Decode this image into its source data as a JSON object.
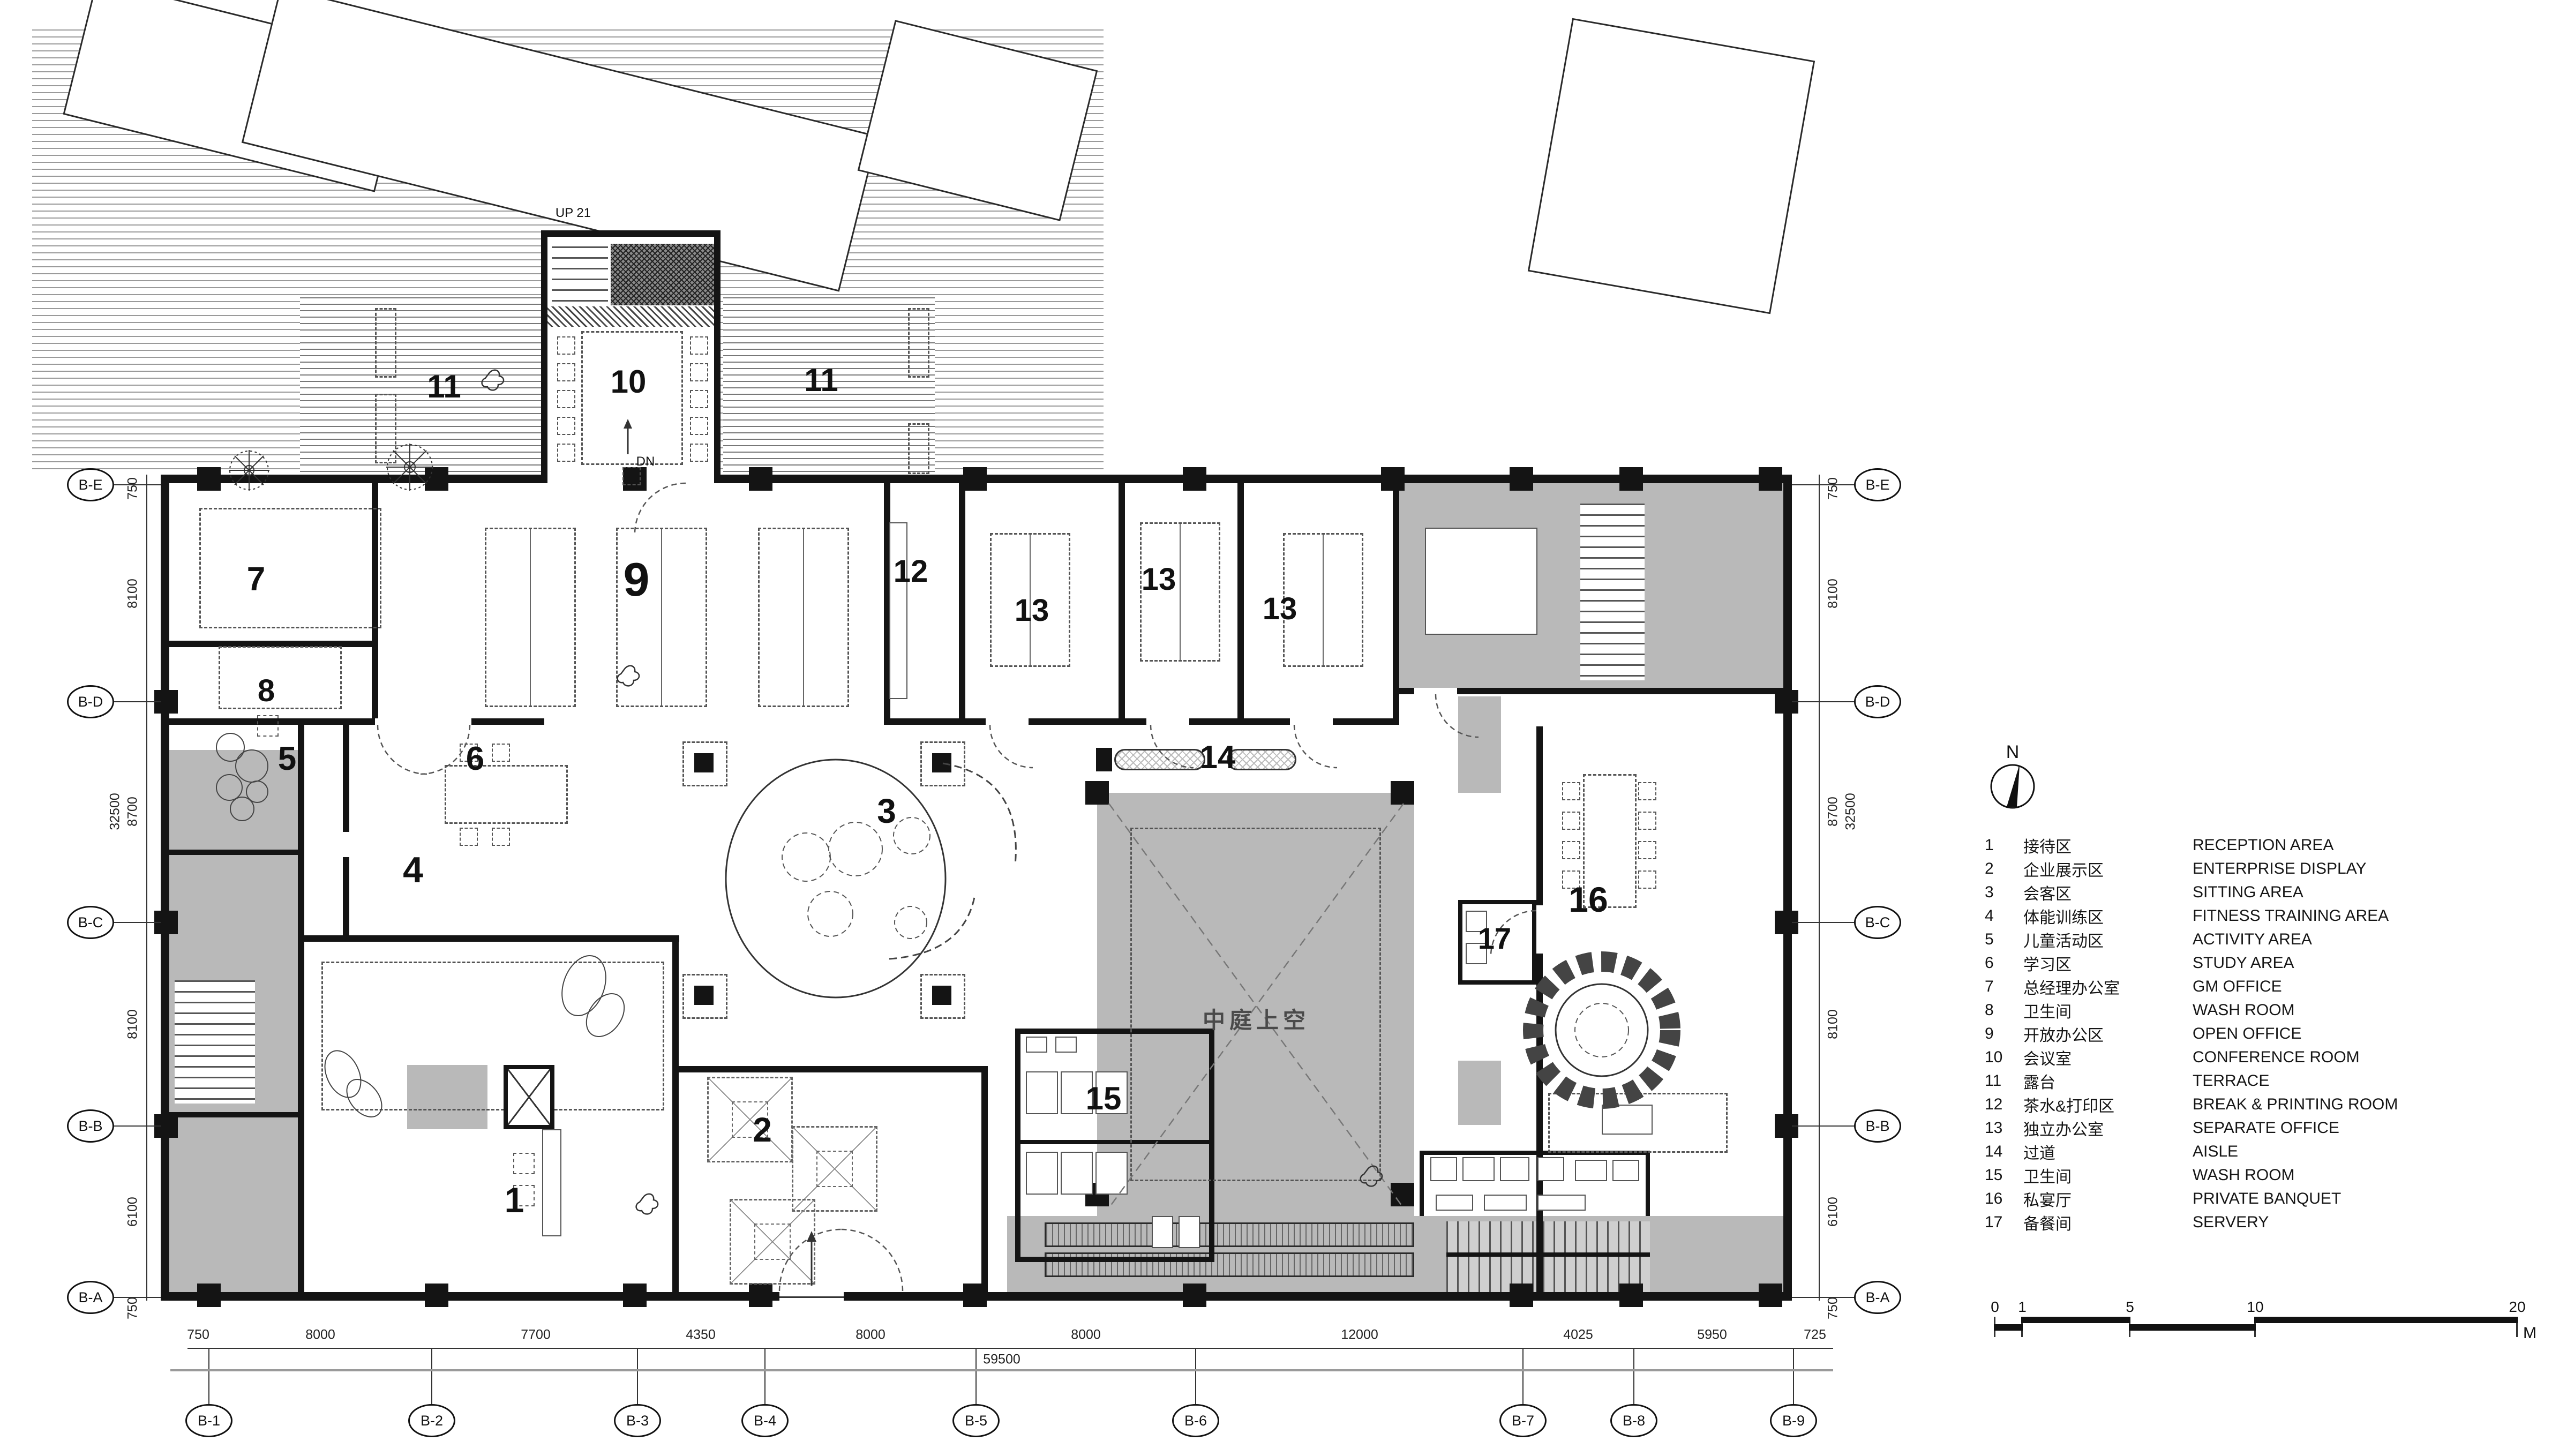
{
  "plan": {
    "rooms": {
      "r1": "1",
      "r2": "2",
      "r3": "3",
      "r4": "4",
      "r5": "5",
      "r6": "6",
      "r7": "7",
      "r8": "8",
      "r9": "9",
      "r10": "10",
      "r11": "11",
      "r12": "12",
      "r13": "13",
      "r14": "14",
      "r15": "15",
      "r16": "16",
      "r17": "17"
    },
    "annotations": {
      "atrium": "中庭上空",
      "up": "UP 21",
      "dn": "DN"
    }
  },
  "legend": {
    "items": [
      {
        "no": "1",
        "zh": "接待区",
        "en": "RECEPTION AREA"
      },
      {
        "no": "2",
        "zh": "企业展示区",
        "en": "ENTERPRISE DISPLAY"
      },
      {
        "no": "3",
        "zh": "会客区",
        "en": "SITTING AREA"
      },
      {
        "no": "4",
        "zh": "体能训练区",
        "en": "FITNESS TRAINING AREA"
      },
      {
        "no": "5",
        "zh": "儿童活动区",
        "en": "ACTIVITY AREA"
      },
      {
        "no": "6",
        "zh": "学习区",
        "en": "STUDY AREA"
      },
      {
        "no": "7",
        "zh": "总经理办公室",
        "en": "GM OFFICE"
      },
      {
        "no": "8",
        "zh": "卫生间",
        "en": "WASH ROOM"
      },
      {
        "no": "9",
        "zh": "开放办公区",
        "en": "OPEN OFFICE"
      },
      {
        "no": "10",
        "zh": "会议室",
        "en": "CONFERENCE ROOM"
      },
      {
        "no": "11",
        "zh": "露台",
        "en": "TERRACE"
      },
      {
        "no": "12",
        "zh": "茶水&打印区",
        "en": "BREAK & PRINTING ROOM"
      },
      {
        "no": "13",
        "zh": "独立办公室",
        "en": "SEPARATE OFFICE"
      },
      {
        "no": "14",
        "zh": "过道",
        "en": "AISLE"
      },
      {
        "no": "15",
        "zh": "卫生间",
        "en": "WASH ROOM"
      },
      {
        "no": "16",
        "zh": "私宴厅",
        "en": "PRIVATE BANQUET"
      },
      {
        "no": "17",
        "zh": "备餐间",
        "en": "SERVERY"
      }
    ]
  },
  "grid": {
    "bottom": [
      "B-1",
      "B-2",
      "B-3",
      "B-4",
      "B-5",
      "B-6",
      "B-7",
      "B-8",
      "B-9"
    ],
    "side": [
      "B-E",
      "B-D",
      "B-C",
      "B-B",
      "B-A"
    ]
  },
  "dimensions": {
    "bottom": [
      "750",
      "8000",
      "7700",
      "4350",
      "8000",
      "8000",
      "12000",
      "4025",
      "5950",
      "725"
    ],
    "bottom_total": "59500",
    "side": [
      "750",
      "8100",
      "8700",
      "8100",
      "6100",
      "750"
    ],
    "side_total": "32500"
  },
  "scalebar": {
    "ticks": [
      "0",
      "1",
      "5",
      "10",
      "20"
    ],
    "unit": "M"
  },
  "north": {
    "label": "N"
  },
  "colors": {
    "wall": "#141414",
    "gray_fill": "#b9b9b9",
    "paper": "#ffffff"
  }
}
